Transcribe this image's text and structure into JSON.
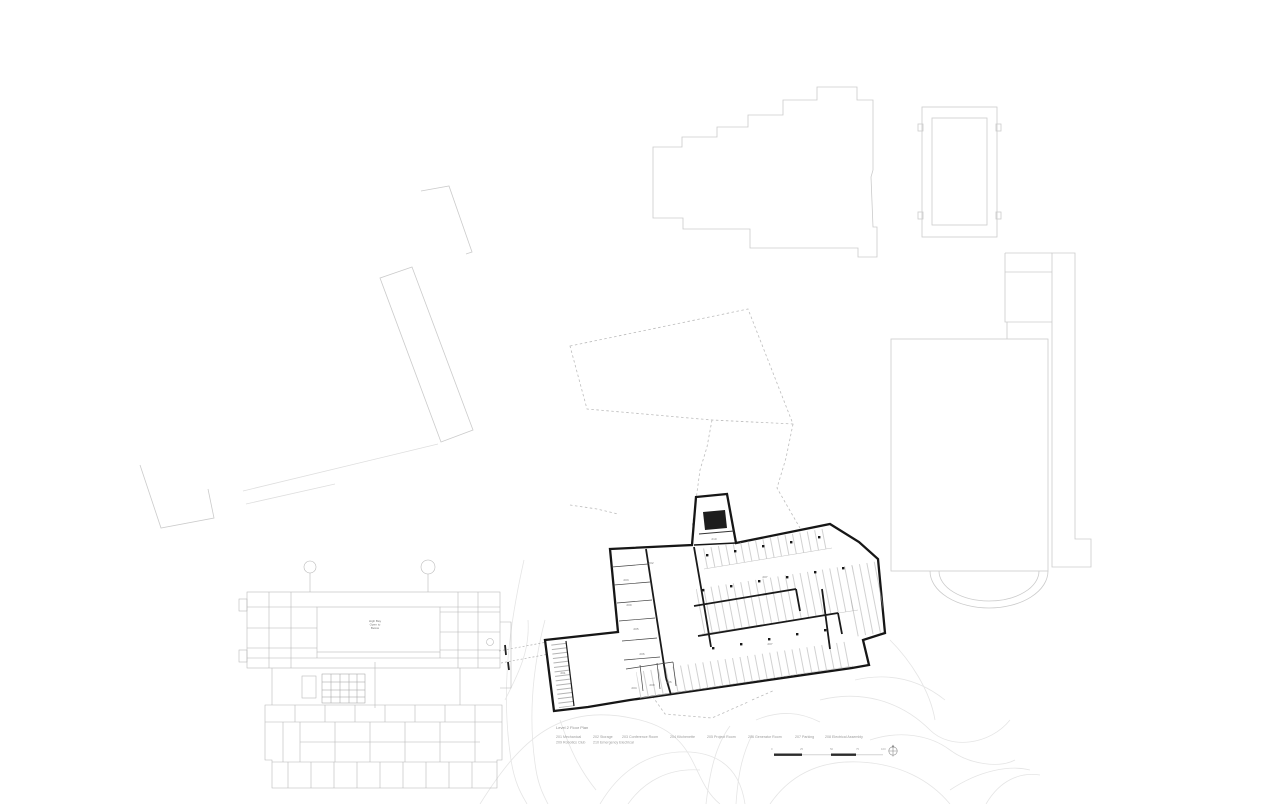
{
  "legend": {
    "title": "Level 2 Floor Plan",
    "rooms": [
      {
        "number": "201",
        "name": "Mechanical"
      },
      {
        "number": "202",
        "name": "Storage"
      },
      {
        "number": "203",
        "name": "Conference Room"
      },
      {
        "number": "204",
        "name": "Kitchenette"
      },
      {
        "number": "205",
        "name": "Project Room"
      },
      {
        "number": "206",
        "name": "Generator Room"
      },
      {
        "number": "207",
        "name": "Parking"
      },
      {
        "number": "208",
        "name": "Electrical Assembly"
      }
    ],
    "rooms_row2": [
      {
        "number": "209",
        "name": "Robotics Club"
      },
      {
        "number": "210",
        "name": "Emergency Electrical"
      }
    ]
  },
  "existing_building": {
    "label_lines": [
      "High Bay",
      "Open to",
      "Below"
    ]
  },
  "plan_labels": [
    {
      "text": "210",
      "x": 714,
      "y": 540
    },
    {
      "text": "202",
      "x": 651,
      "y": 564
    },
    {
      "text": "203",
      "x": 626,
      "y": 581
    },
    {
      "text": "209",
      "x": 629,
      "y": 606
    },
    {
      "text": "205",
      "x": 636,
      "y": 630
    },
    {
      "text": "206",
      "x": 642,
      "y": 655
    },
    {
      "text": "204",
      "x": 634,
      "y": 689
    },
    {
      "text": "208",
      "x": 652,
      "y": 686
    },
    {
      "text": "206",
      "x": 669,
      "y": 683
    },
    {
      "text": "201",
      "x": 563,
      "y": 674
    },
    {
      "text": "207",
      "x": 765,
      "y": 578
    },
    {
      "text": "207",
      "x": 770,
      "y": 645
    }
  ],
  "scale_bar": {
    "tick_labels": [
      "0",
      "25",
      "50",
      "75",
      "100"
    ]
  },
  "colors": {
    "plan_line": "#161616",
    "site_line": "#cbcbcb",
    "existing_line": "#b4b4b4",
    "contour_line": "#e5e5e5",
    "dashed_line": "#bcbcbc",
    "text": "#9a9a9a"
  }
}
